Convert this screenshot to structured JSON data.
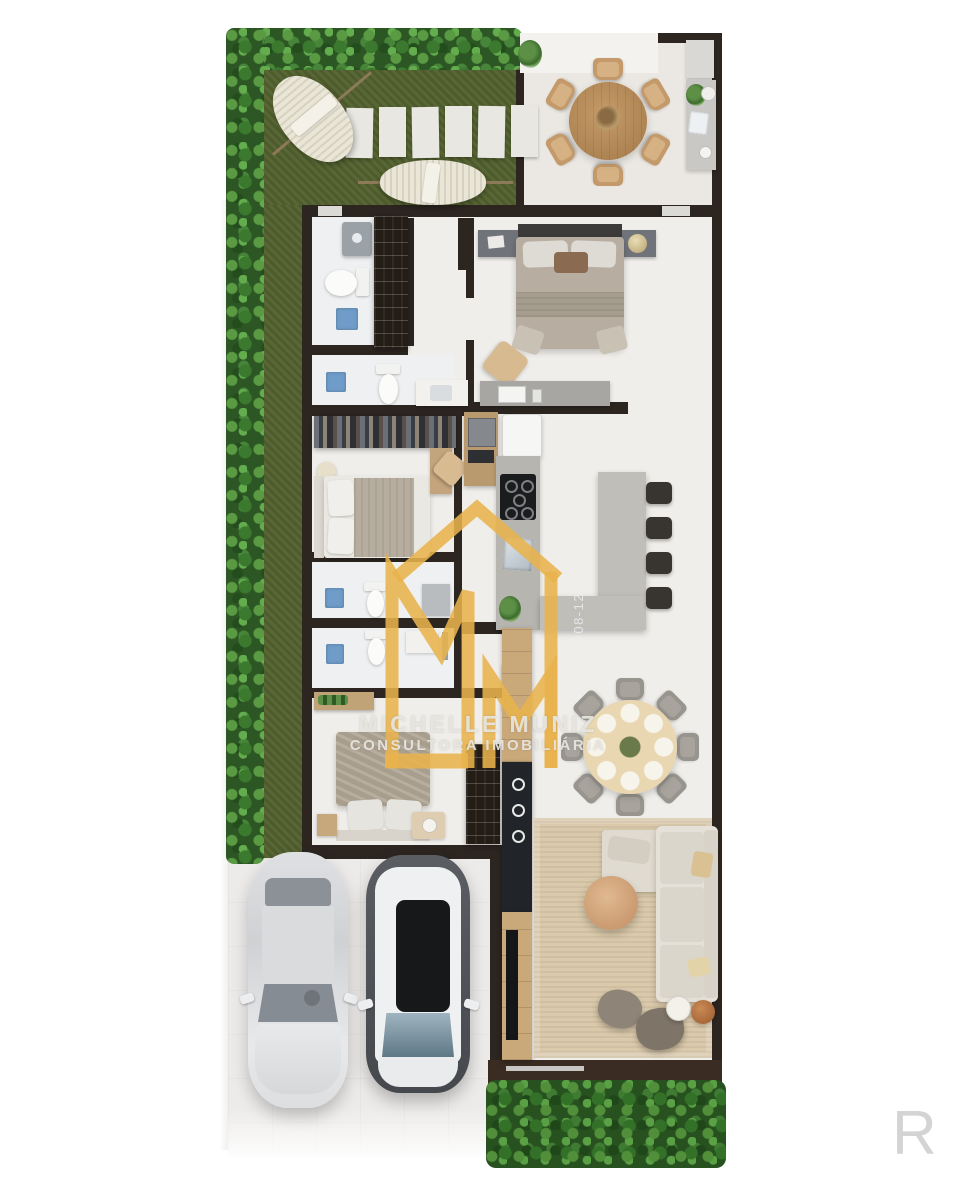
{
  "watermark": {
    "monogram": "MM",
    "brand_line1": "MICHELLE MUNIZ",
    "brand_line2": "CONSULTORA IMOBILIÁRIA",
    "license_code": "C/7908-12",
    "corner_letter": "R",
    "gold_color": "#E8B34C",
    "text_color": "#E2E0DA"
  },
  "palette": {
    "wall": "#2C2520",
    "floor": "#EFEDEA",
    "grass": "#54622F",
    "hedge": "#2C5724",
    "rug": "#D8C7A8",
    "shower_blue": "#6F9CC8",
    "wood": "#B98D5F",
    "island_gray": "#C0BEB9"
  },
  "scene": {
    "type": "residential-floor-plan-3d-top-view",
    "outdoor_elements": [
      "hedge-border",
      "lawn",
      "hammock",
      "hammock",
      "stepping-stones",
      "round-patio-table",
      "patio-chairs-x6",
      "outdoor-counter"
    ],
    "rooms": [
      "patio",
      "master-bedroom",
      "bathroom-1",
      "shoe-closet",
      "bedroom-2",
      "wardrobe",
      "bathroom-2",
      "bathroom-3",
      "bathroom-4",
      "bedroom-3",
      "kitchen",
      "dining-room",
      "living-room",
      "garage-driveway"
    ],
    "vehicles": [
      "silver-sedan",
      "white-suv"
    ]
  }
}
